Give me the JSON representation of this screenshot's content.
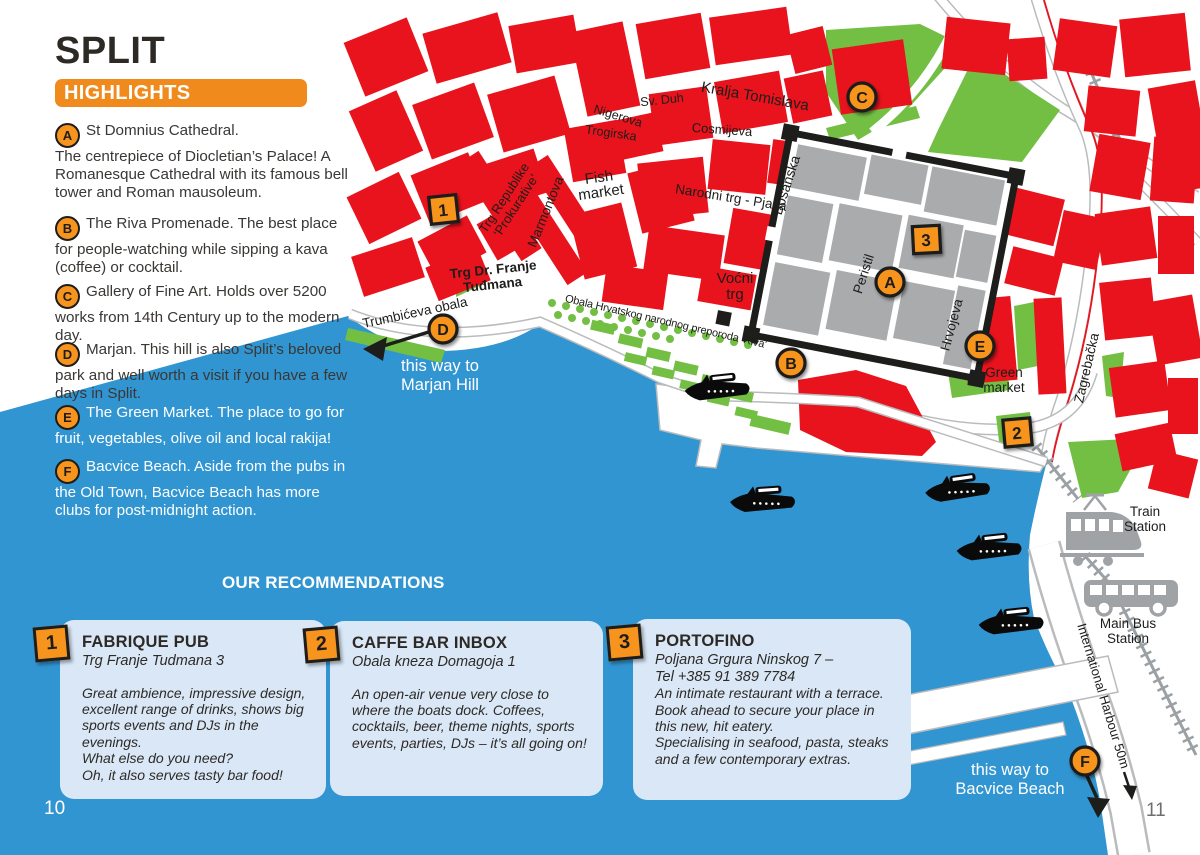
{
  "page": {
    "left_page_number": "10",
    "right_page_number": "11"
  },
  "header": {
    "title": "SPLIT",
    "banner": "HIGHLIGHTS"
  },
  "highlights": [
    {
      "letter": "A",
      "text": "St Domnius Cathedral.\nThe centrepiece of Diocletian’s Palace! A Romanesque Cathedral with its famous bell tower and Roman mausoleum."
    },
    {
      "letter": "B",
      "text": "The Riva Promenade. The best place for people-watching while sipping a kava (coffee) or cocktail."
    },
    {
      "letter": "C",
      "text": "Gallery of Fine Art. Holds over 5200 works from 14th Century up to the modern day."
    },
    {
      "letter": "D",
      "text": "Marjan. This hill is also Split’s beloved park and well worth a visit if you have a few days in Split."
    },
    {
      "letter": "E",
      "text": "The Green Market. The place to go for fruit, vegetables, olive oil and local rakija!"
    },
    {
      "letter": "F",
      "text": "Bacvice Beach. Aside from the pubs in the Old Town, Bacvice Beach has more clubs for post-midnight action."
    }
  ],
  "recommendations": {
    "heading": "OUR RECOMMENDATIONS",
    "cards": [
      {
        "number": "1",
        "name": "FABRIQUE PUB",
        "address": "Trg Franje Tudmana 3",
        "description": "Great ambience, impressive design, excellent range of drinks, shows big sports events and DJs in the evenings.\nWhat else do you need?\nOh, it also serves tasty bar food!"
      },
      {
        "number": "2",
        "name": "CAFFE BAR INBOX",
        "address": "Obala kneza Domagoja 1",
        "description": "An open-air venue very close to where the boats dock. Coffees, cocktails, beer, theme nights, sports events, parties, DJs – it’s all going on!"
      },
      {
        "number": "3",
        "name": "PORTOFINO",
        "address": "Poljana Grgura Ninskog 7 –\nTel +385 91 389 7784",
        "description": "An intimate restaurant with a terrace. Book ahead to secure your place in this new, hit eatery.\nSpecialising in seafood, pasta, steaks and a few contemporary extras."
      }
    ]
  },
  "map": {
    "streets": {
      "kralja_tomislava": "Kralja Tomislava",
      "sv_duh": "Sv. Duh",
      "nigerova": "Nigerova",
      "trogirska": "Trogirska",
      "cosmijeva": "Cosmijeva",
      "bosanska": "Bosanska",
      "narodni_trg": "Narodni trg - Pjaca",
      "marmontova": "Marmontova",
      "trg_republike_1": "Trg Republike",
      "trg_republike_2": "‘Prokurative’",
      "trg_tudmana_1": "Trg Dr. Franje",
      "trg_tudmana_2": "Tuđmana",
      "trumbiceva_obala": "Trumbićeva obala",
      "obala_riva": "Obala Hrvatskog narodnog preporoda ‘Riva’",
      "hrvojeva": "Hrvojeva",
      "zagrebacka": "Zagrebačka",
      "international_harbour": "International Harbour 50m"
    },
    "places": {
      "fish_market_1": "Fish",
      "fish_market_2": "market",
      "vocni_trg_1": "Voćni",
      "vocni_trg_2": "trg",
      "peristil": "Peristil",
      "green_market_1": "Green",
      "green_market_2": "market",
      "train_station_1": "Train",
      "train_station_2": "Station",
      "bus_station_1": "Main Bus",
      "bus_station_2": "Station"
    },
    "markers": {
      "a": "A",
      "b": "B",
      "c": "C",
      "d": "D",
      "e": "E",
      "f": "F",
      "n1": "1",
      "n2": "2",
      "n3": "3"
    },
    "directions": {
      "marjan_1": "this way to",
      "marjan_2": "Marjan Hill",
      "bacvice_1": "this way to",
      "bacvice_2": "Bacvice Beach"
    }
  },
  "colors": {
    "sea": "#3195d2",
    "building_red": "#e8131c",
    "park_green": "#72bf44",
    "palace_gray": "#a9abad",
    "marker_orange": "#f7941d",
    "highlight_orange": "#f18a1d",
    "card_background": "#d9e7f6",
    "railway_gray": "#9aa0a4",
    "text_dark": "#2d2a26",
    "page_number_gray": "#6d6e70",
    "marker_outline": "#1d1d1b"
  }
}
